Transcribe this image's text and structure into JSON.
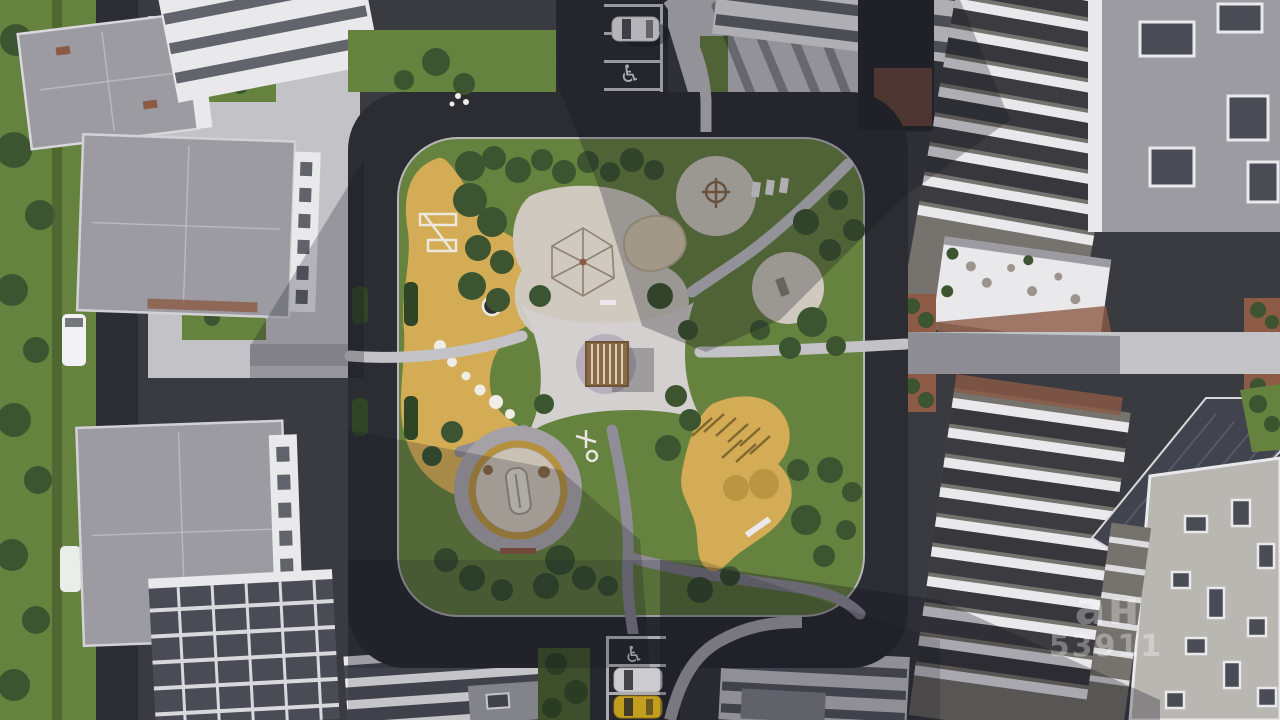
{
  "meta": {
    "alt": "Top-down aerial architectural rendering of a residential complex courtyard with playgrounds, lawns, ring road, parked cars and surrounding apartment buildings"
  },
  "palette": {
    "asphalt": "#3a3a41",
    "asphalt_dark": "#2c2c33",
    "paver": "#c3c2c6",
    "paver_shade": "#8f8d98",
    "lawn": "#66823f",
    "lawn_shade": "#465c2e",
    "tree": "#3c5530",
    "tree_dark": "#2f4526",
    "tan": "#d3ac55",
    "tan_shade": "#b5913f",
    "sand": "#cfc9c0",
    "mound": "#d8cbb0",
    "roof": "#9b9ba1",
    "roof_light": "#b9b7b2",
    "roof_dark": "#41444e",
    "white": "#e9e9ec",
    "facade_dark": "#4a4c55",
    "brick": "#8c5a45",
    "wood": "#8a6a46",
    "car_white": "#f2f2f4",
    "car_dark": "#23242c",
    "car_yellow": "#e6bd1d",
    "watermark": "#ffffff"
  },
  "watermark": {
    "logo": "ан",
    "id": "53911"
  },
  "road_markings": {
    "accessible_icon_glyph": "♿"
  }
}
